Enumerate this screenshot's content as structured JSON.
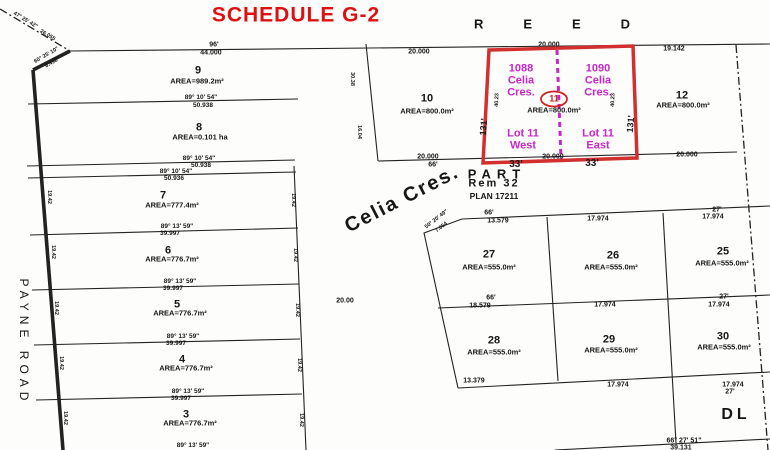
{
  "map_title": "SCHEDULE G-2",
  "colors": {
    "title_red": "#dd1111",
    "highlight_red": "#d22f2f",
    "magenta": "#c627c6",
    "line_black": "#222222"
  },
  "highlighted_parcel": {
    "lot": "11",
    "addresses": [
      "1088 Celia Cres.",
      "1090 Celia Cres."
    ],
    "halves": [
      "Lot 11 West",
      "Lot 11 East"
    ],
    "area": "AREA=800.0m²"
  },
  "labels": [
    {
      "n": "map-title",
      "t": "SCHEDULE G-2",
      "x": 296,
      "y": 15,
      "s": 21,
      "w": 800,
      "c": "#dd1111",
      "l": 1
    },
    {
      "n": "street-reed",
      "t": "REED",
      "x": 572,
      "y": 24,
      "s": 13,
      "w": 600,
      "l": 40
    },
    {
      "n": "street-payne-road",
      "t": "PAYNE ROAD",
      "x": 24,
      "y": 342,
      "s": 12,
      "w": 500,
      "l": 5,
      "r": 90
    },
    {
      "n": "street-celia-cres",
      "t": "Celia Cres.",
      "x": 402,
      "y": 199,
      "s": 20,
      "w": 700,
      "l": 2,
      "r": -27
    },
    {
      "n": "part-label",
      "t": "PART",
      "x": 497,
      "y": 174,
      "s": 13,
      "w": 600,
      "l": 6
    },
    {
      "n": "rem-32-label",
      "t": "Rem 32",
      "x": 494,
      "y": 184,
      "s": 11,
      "w": 600,
      "l": 2
    },
    {
      "n": "plan-17211-label",
      "t": "PLAN 17211",
      "x": 494,
      "y": 196,
      "s": 8.5,
      "w": 700
    },
    {
      "n": "dl-label",
      "t": "DL",
      "x": 736,
      "y": 415,
      "s": 16,
      "w": 600,
      "l": 4
    },
    {
      "n": "bearing-nw",
      "t": "47° 25' 42\"",
      "x": 25,
      "y": 21,
      "s": 5.5,
      "w": 600,
      "r": 31
    },
    {
      "n": "dist-nw",
      "t": "26.055",
      "x": 47,
      "y": 36,
      "s": 5.5,
      "w": 600,
      "r": 31
    },
    {
      "n": "bearing-corner",
      "t": "60° 25' 10\"",
      "x": 47,
      "y": 56,
      "s": 5.5,
      "w": 600,
      "r": -30
    },
    {
      "n": "dist-corner",
      "t": "6.492",
      "x": 52,
      "y": 64,
      "s": 5.5,
      "w": 600,
      "r": -30
    },
    {
      "n": "dim-96ft",
      "t": "96'",
      "x": 214,
      "y": 45,
      "s": 7,
      "w": 600
    },
    {
      "n": "dim-44000",
      "t": "44.000",
      "x": 211,
      "y": 53,
      "s": 7,
      "w": 600
    },
    {
      "n": "dim-20000-lot10",
      "t": "20.000",
      "x": 419,
      "y": 52,
      "s": 7,
      "w": 600
    },
    {
      "n": "dim-20000-lot11-top",
      "t": "20.000",
      "x": 549,
      "y": 45,
      "s": 7,
      "w": 600
    },
    {
      "n": "dim-19142",
      "t": "19.142",
      "x": 674,
      "y": 49,
      "s": 7,
      "w": 600
    },
    {
      "n": "lot-9-number",
      "t": "9",
      "x": 198,
      "y": 71,
      "s": 11,
      "w": 700
    },
    {
      "n": "lot-9-area",
      "t": "AREA=989.2m²",
      "x": 197,
      "y": 81,
      "s": 7.5,
      "w": 700
    },
    {
      "n": "bearing-1",
      "t": "89° 10' 54\"",
      "x": 201,
      "y": 98,
      "s": 6.5,
      "w": 600
    },
    {
      "n": "dist-1",
      "t": "50.938",
      "x": 203,
      "y": 106,
      "s": 6.5,
      "w": 600
    },
    {
      "n": "lot-8-number",
      "t": "8",
      "x": 199,
      "y": 128,
      "s": 11,
      "w": 700
    },
    {
      "n": "lot-8-area",
      "t": "AREA=0.101 ha",
      "x": 200,
      "y": 137,
      "s": 7.5,
      "w": 700
    },
    {
      "n": "bearing-2",
      "t": "89° 10' 54\"",
      "x": 199,
      "y": 159,
      "s": 6.5,
      "w": 600
    },
    {
      "n": "dist-2",
      "t": "50.938",
      "x": 201,
      "y": 166,
      "s": 6.5,
      "w": 600
    },
    {
      "n": "bearing-3",
      "t": "89° 10' 54\"",
      "x": 176,
      "y": 172,
      "s": 6.5,
      "w": 600
    },
    {
      "n": "dist-3",
      "t": "50.936",
      "x": 174,
      "y": 179,
      "s": 6.5,
      "w": 600
    },
    {
      "n": "lot-7-number",
      "t": "7",
      "x": 163,
      "y": 196,
      "s": 11,
      "w": 700
    },
    {
      "n": "lot-7-area",
      "t": "AREA=777.4m²",
      "x": 172,
      "y": 205,
      "s": 7.5,
      "w": 700
    },
    {
      "n": "bearing-4",
      "t": "89° 13' 59\"",
      "x": 177,
      "y": 227,
      "s": 6.5,
      "w": 600
    },
    {
      "n": "dist-4",
      "t": "39.997",
      "x": 170,
      "y": 234,
      "s": 6.5,
      "w": 600
    },
    {
      "n": "lot-6-number",
      "t": "6",
      "x": 168,
      "y": 251,
      "s": 11,
      "w": 700
    },
    {
      "n": "lot-6-area",
      "t": "AREA=776.7m²",
      "x": 172,
      "y": 259,
      "s": 7.5,
      "w": 700
    },
    {
      "n": "bearing-5",
      "t": "89° 13' 59\"",
      "x": 180,
      "y": 282,
      "s": 6.5,
      "w": 600
    },
    {
      "n": "dist-5",
      "t": "39.997",
      "x": 173,
      "y": 289,
      "s": 6.5,
      "w": 600
    },
    {
      "n": "lot-5-number",
      "t": "5",
      "x": 177,
      "y": 305,
      "s": 11,
      "w": 700
    },
    {
      "n": "lot-5-area",
      "t": "AREA=776.7m²",
      "x": 180,
      "y": 313,
      "s": 7.5,
      "w": 700
    },
    {
      "n": "bearing-6",
      "t": "89° 13' 59\"",
      "x": 183,
      "y": 337,
      "s": 6.5,
      "w": 600
    },
    {
      "n": "dist-6",
      "t": "39.997",
      "x": 176,
      "y": 344,
      "s": 6.5,
      "w": 600
    },
    {
      "n": "lot-4-number",
      "t": "4",
      "x": 182,
      "y": 360,
      "s": 11,
      "w": 700
    },
    {
      "n": "lot-4-area",
      "t": "AREA=776.7m²",
      "x": 186,
      "y": 368,
      "s": 7.5,
      "w": 700
    },
    {
      "n": "bearing-7",
      "t": "89° 13' 59\"",
      "x": 188,
      "y": 392,
      "s": 6.5,
      "w": 600
    },
    {
      "n": "dist-7",
      "t": "39.997",
      "x": 181,
      "y": 399,
      "s": 6.5,
      "w": 600
    },
    {
      "n": "lot-3-number",
      "t": "3",
      "x": 186,
      "y": 415,
      "s": 11,
      "w": 700
    },
    {
      "n": "lot-3-area",
      "t": "AREA=776.7m²",
      "x": 190,
      "y": 423,
      "s": 7.5,
      "w": 700
    },
    {
      "n": "bearing-8",
      "t": "89° 13' 59\"",
      "x": 193,
      "y": 446,
      "s": 6.5,
      "w": 600
    },
    {
      "n": "depth-7-left",
      "t": "19.42",
      "x": 48,
      "y": 197,
      "s": 5.5,
      "w": 600,
      "r": 90
    },
    {
      "n": "depth-6-left",
      "t": "19.42",
      "x": 52,
      "y": 252,
      "s": 5.5,
      "w": 600,
      "r": 90
    },
    {
      "n": "depth-5-left",
      "t": "19.42",
      "x": 55,
      "y": 308,
      "s": 5.5,
      "w": 600,
      "r": 90
    },
    {
      "n": "depth-4-left",
      "t": "19.42",
      "x": 60,
      "y": 363,
      "s": 5.5,
      "w": 600,
      "r": 90
    },
    {
      "n": "depth-3-left",
      "t": "19.42",
      "x": 64,
      "y": 418,
      "s": 5.5,
      "w": 600,
      "r": 90
    },
    {
      "n": "depth-7-right",
      "t": "19.42",
      "x": 292,
      "y": 200,
      "s": 5.5,
      "w": 600,
      "r": 90
    },
    {
      "n": "depth-6-right",
      "t": "19.42",
      "x": 294,
      "y": 255,
      "s": 5.5,
      "w": 600,
      "r": 90
    },
    {
      "n": "depth-5-right",
      "t": "19.42",
      "x": 296,
      "y": 310,
      "s": 5.5,
      "w": 600,
      "r": 90
    },
    {
      "n": "depth-4-right",
      "t": "19.42",
      "x": 298,
      "y": 365,
      "s": 5.5,
      "w": 600,
      "r": 90
    },
    {
      "n": "depth-3-right",
      "t": "19.42",
      "x": 300,
      "y": 420,
      "s": 5.5,
      "w": 600,
      "r": 90
    },
    {
      "n": "lot-10-number",
      "t": "10",
      "x": 427,
      "y": 99,
      "s": 11,
      "w": 700
    },
    {
      "n": "lot-10-area",
      "t": "AREA=800.0m²",
      "x": 427,
      "y": 111,
      "s": 7.5,
      "w": 700
    },
    {
      "n": "dim-20000-lot10-bottom",
      "t": "20.000",
      "x": 428,
      "y": 157,
      "s": 7,
      "w": 600
    },
    {
      "n": "dim-66ft-lot10",
      "t": "66'",
      "x": 433,
      "y": 165,
      "s": 7,
      "w": 600
    },
    {
      "n": "edge-3038",
      "t": "30.38",
      "x": 351,
      "y": 79,
      "s": 5.5,
      "w": 600,
      "r": 90
    },
    {
      "n": "edge-1604",
      "t": "16.04",
      "x": 358,
      "y": 132,
      "s": 5.5,
      "w": 600,
      "r": 90
    },
    {
      "n": "lot-12-number",
      "t": "12",
      "x": 682,
      "y": 96,
      "s": 11,
      "w": 700
    },
    {
      "n": "lot-12-area",
      "t": "AREA=800.0m²",
      "x": 683,
      "y": 105,
      "s": 7.5,
      "w": 700
    },
    {
      "n": "dim-20000-lot12",
      "t": "20.000",
      "x": 687,
      "y": 155,
      "s": 7,
      "w": 600
    },
    {
      "n": "addr-1088-line1",
      "t": "1088",
      "x": 521,
      "y": 69,
      "s": 11,
      "w": 700,
      "c": "#c627c6"
    },
    {
      "n": "addr-1088-line2",
      "t": "Celia",
      "x": 521,
      "y": 81,
      "s": 11,
      "w": 700,
      "c": "#c627c6"
    },
    {
      "n": "addr-1088-line3",
      "t": "Cres.",
      "x": 521,
      "y": 93,
      "s": 11,
      "w": 700,
      "c": "#c627c6"
    },
    {
      "n": "addr-1090-line1",
      "t": "1090",
      "x": 598,
      "y": 69,
      "s": 11,
      "w": 700,
      "c": "#c627c6"
    },
    {
      "n": "addr-1090-line2",
      "t": "Celia",
      "x": 598,
      "y": 81,
      "s": 11,
      "w": 700,
      "c": "#c627c6"
    },
    {
      "n": "addr-1090-line3",
      "t": "Cres.",
      "x": 598,
      "y": 93,
      "s": 11,
      "w": 700,
      "c": "#c627c6"
    },
    {
      "n": "lot-11-number",
      "t": "11",
      "x": 554,
      "y": 99,
      "s": 9,
      "w": 700,
      "c": "#cc2222"
    },
    {
      "n": "lot-11-area",
      "t": "AREA=800.0m²",
      "x": 554,
      "y": 110,
      "s": 7.5,
      "w": 700
    },
    {
      "n": "lot-11-west-line1",
      "t": "Lot 11",
      "x": 523,
      "y": 134,
      "s": 11,
      "w": 700,
      "c": "#c627c6"
    },
    {
      "n": "lot-11-west-line2",
      "t": "West",
      "x": 523,
      "y": 146,
      "s": 11,
      "w": 700,
      "c": "#c627c6"
    },
    {
      "n": "lot-11-east-line1",
      "t": "Lot 11",
      "x": 598,
      "y": 134,
      "s": 11,
      "w": 700,
      "c": "#c627c6"
    },
    {
      "n": "lot-11-east-line2",
      "t": "East",
      "x": 598,
      "y": 146,
      "s": 11,
      "w": 700,
      "c": "#c627c6"
    },
    {
      "n": "dim-20000-lot11-bottom",
      "t": "20.000",
      "x": 553,
      "y": 157,
      "s": 7,
      "w": 600
    },
    {
      "n": "dim-33ft-west",
      "t": "33'",
      "x": 516,
      "y": 165,
      "s": 10,
      "w": 700
    },
    {
      "n": "dim-33ft-east",
      "t": "33'",
      "x": 592,
      "y": 164,
      "s": 10,
      "w": 700
    },
    {
      "n": "dim-131ft-left",
      "t": "131'",
      "x": 484,
      "y": 127,
      "s": 9,
      "w": 700,
      "r": -85
    },
    {
      "n": "dim-131ft-right",
      "t": "131'",
      "x": 631,
      "y": 124,
      "s": 9,
      "w": 700,
      "r": -85
    },
    {
      "n": "dim-4023-left",
      "t": "40.23",
      "x": 498,
      "y": 100,
      "s": 5.5,
      "w": 600,
      "r": -88
    },
    {
      "n": "dim-4023-right",
      "t": "40.23",
      "x": 614,
      "y": 100,
      "s": 5.5,
      "w": 600,
      "r": -88
    },
    {
      "n": "dim-2000-road",
      "t": "20.00",
      "x": 345,
      "y": 301,
      "s": 7,
      "w": 700
    },
    {
      "n": "bearing-corner-27",
      "t": "50° 20' 49\"",
      "x": 437,
      "y": 220,
      "s": 5.5,
      "w": 600,
      "r": -38
    },
    {
      "n": "dist-corner-27",
      "t": "7.054",
      "x": 442,
      "y": 228,
      "s": 5.5,
      "w": 600,
      "r": -38
    },
    {
      "n": "dim-66ft-27top",
      "t": "66'",
      "x": 489,
      "y": 213,
      "s": 7,
      "w": 600
    },
    {
      "n": "dim-13579-top",
      "t": "13.579",
      "x": 498,
      "y": 221,
      "s": 7,
      "w": 600
    },
    {
      "n": "dim-17974-26top",
      "t": "17.974",
      "x": 598,
      "y": 219,
      "s": 7,
      "w": 600
    },
    {
      "n": "dim-27ft-25top",
      "t": "27'",
      "x": 717,
      "y": 210,
      "s": 7,
      "w": 600
    },
    {
      "n": "dim-17974-25top",
      "t": "17.974",
      "x": 713,
      "y": 217,
      "s": 7,
      "w": 600
    },
    {
      "n": "lot-27-number",
      "t": "27",
      "x": 489,
      "y": 255,
      "s": 11,
      "w": 700
    },
    {
      "n": "lot-27-area",
      "t": "AREA=555.0m²",
      "x": 489,
      "y": 267,
      "s": 7.5,
      "w": 700
    },
    {
      "n": "lot-26-number",
      "t": "26",
      "x": 613,
      "y": 256,
      "s": 11,
      "w": 700
    },
    {
      "n": "lot-26-area",
      "t": "AREA=555.0m²",
      "x": 611,
      "y": 267,
      "s": 7.5,
      "w": 700
    },
    {
      "n": "lot-25-number",
      "t": "25",
      "x": 723,
      "y": 252,
      "s": 11,
      "w": 700
    },
    {
      "n": "lot-25-area",
      "t": "AREA=555.0m²",
      "x": 722,
      "y": 263,
      "s": 7.5,
      "w": 700
    },
    {
      "n": "dim-66ft-27bottom",
      "t": "66'",
      "x": 491,
      "y": 298,
      "s": 7,
      "w": 600
    },
    {
      "n": "dim-18579",
      "t": "18.579",
      "x": 480,
      "y": 306,
      "s": 7,
      "w": 600
    },
    {
      "n": "dim-17974-mid",
      "t": "17.974",
      "x": 605,
      "y": 305,
      "s": 7,
      "w": 600
    },
    {
      "n": "dim-27ft-mid",
      "t": "27'",
      "x": 724,
      "y": 297,
      "s": 7,
      "w": 600
    },
    {
      "n": "dim-17974-mid2",
      "t": "17.974",
      "x": 719,
      "y": 305,
      "s": 7,
      "w": 600
    },
    {
      "n": "lot-28-number",
      "t": "28",
      "x": 494,
      "y": 341,
      "s": 11,
      "w": 700
    },
    {
      "n": "lot-28-area",
      "t": "AREA=555.0m²",
      "x": 494,
      "y": 352,
      "s": 7.5,
      "w": 700
    },
    {
      "n": "lot-29-number",
      "t": "29",
      "x": 609,
      "y": 340,
      "s": 11,
      "w": 700
    },
    {
      "n": "lot-29-area",
      "t": "AREA=555.0m²",
      "x": 611,
      "y": 350,
      "s": 7.5,
      "w": 700
    },
    {
      "n": "lot-30-number",
      "t": "30",
      "x": 723,
      "y": 337,
      "s": 11,
      "w": 700
    },
    {
      "n": "lot-30-area",
      "t": "AREA=555.0m²",
      "x": 724,
      "y": 347,
      "s": 7.5,
      "w": 700
    },
    {
      "n": "dim-13379",
      "t": "13.379",
      "x": 474,
      "y": 381,
      "s": 7,
      "w": 600
    },
    {
      "n": "dim-17974-29bottom",
      "t": "17.974",
      "x": 618,
      "y": 385,
      "s": 7,
      "w": 600
    },
    {
      "n": "dim-17974-30bottom",
      "t": "17.974",
      "x": 733,
      "y": 385,
      "s": 7,
      "w": 600
    },
    {
      "n": "dim-27ft-30bottom",
      "t": "27'",
      "x": 730,
      "y": 392,
      "s": 7,
      "w": 600
    },
    {
      "n": "bearing-dl",
      "t": "66° 27' 51\"",
      "x": 684,
      "y": 441,
      "s": 7,
      "w": 600
    },
    {
      "n": "dist-dl",
      "t": "39.131",
      "x": 681,
      "y": 448,
      "s": 7,
      "w": 600
    }
  ]
}
